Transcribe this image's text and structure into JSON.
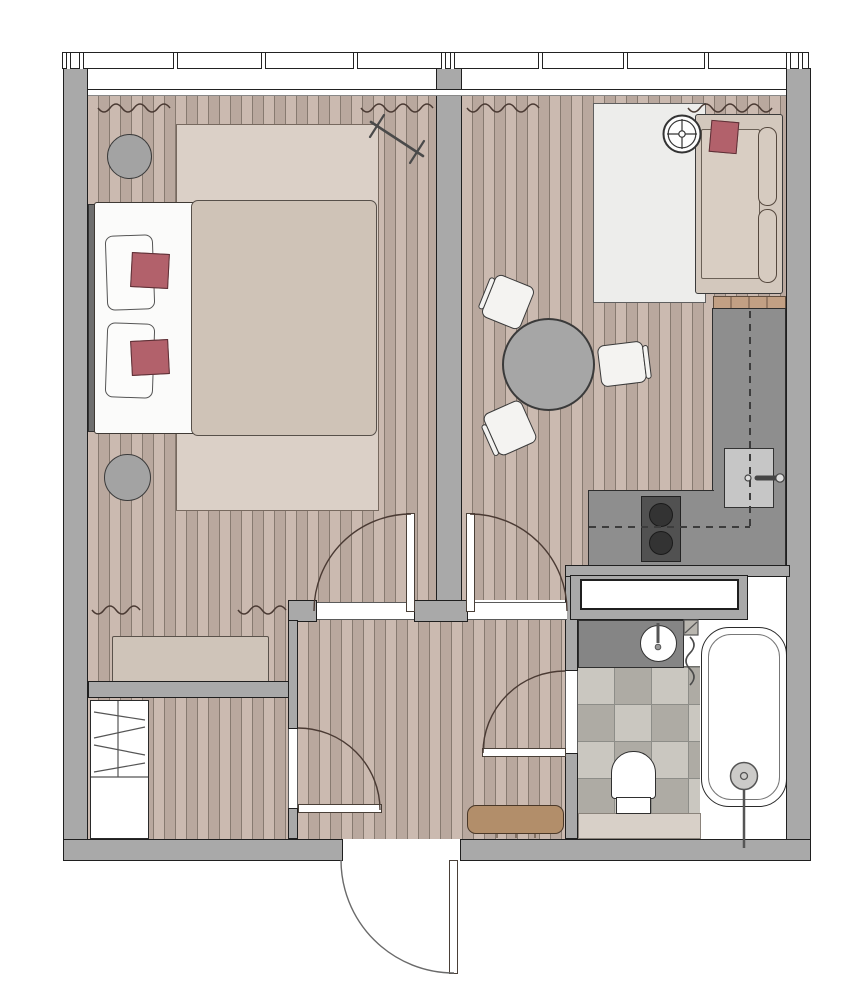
{
  "title": "One-room apartment floor plan",
  "palette": {
    "wall": "#a9a9a9",
    "wallLine": "#1f1f1f",
    "floorA": "#cbbab0",
    "floorB": "#b9a89e",
    "floorLine": "#877a70",
    "rugBedroom": "#dbd0c7",
    "rugLiving": "#ededeb",
    "bedding": "#cfc3b7",
    "white": "#fbfbfa",
    "accentRed": "#b2616b",
    "counter": "#8e8e8e",
    "cooktop": "#515151",
    "vanity": "#858585",
    "tileA": "#cac7c0",
    "tileB": "#aeaba4",
    "bench": "#b28e6a",
    "dresser": "#cfc4b9",
    "stool": "#a3a3a3",
    "table": "#a6a6a6",
    "sofa": "#d3c8bd",
    "tan": "#c2a084",
    "mat": "#d8d0c8"
  },
  "rooms": {
    "bedroom": "Bedroom",
    "living": "Living room with kitchen",
    "kitchen": "Kitchen zone",
    "bathroom": "Bathroom",
    "hallway": "Hallway",
    "closet": "Walk-in closet"
  },
  "furniture": {
    "window": "Window band with mullions",
    "curtain": "Curtain",
    "bed": "Double bed",
    "duvet": "Duvet",
    "pillow": "Pillow",
    "cushion": "Accent cushion",
    "headboard": "Headboard",
    "stool": "Bedside stool",
    "bedroomRug": "Bedroom rug",
    "dresser": "Dresser bench",
    "rack": "Wall-mounted rack",
    "sofa": "Sofa",
    "sofaCushion": "Sofa cushion",
    "lamp": "Floor lamp",
    "livingRug": "Living room rug",
    "radiatorShelf": "Radiator shelf",
    "table": "Dining table",
    "chair": "Dining chair",
    "counter": "Kitchen counter",
    "cooktopLabel": "Two-burner cooktop",
    "burner": "Burner",
    "sink": "Kitchen sink",
    "upperCabinets": "Upper cabinets (dashed outline)",
    "tub": "Bathtub",
    "drain": "Bath drain with hand shower",
    "toilet": "Toilet",
    "vanity": "Vanity counter",
    "basin": "Wash basin",
    "towelRadiator": "Towel radiator",
    "builtinCabinet": "Built-in cabinet",
    "bathMat": "Bath mat strip",
    "wardrobe": "Wardrobe with shelves",
    "hallBench": "Hallway bench",
    "doorEntrance": "Entrance door",
    "doorBedroom": "Bedroom door",
    "doorLiving": "Living room door",
    "doorCloset": "Closet door",
    "doorBath": "Bathroom door"
  },
  "counts": {
    "mullions": 12,
    "diningChairs": 3,
    "burners": 2,
    "pillows": 2,
    "accentCushions": 3
  }
}
